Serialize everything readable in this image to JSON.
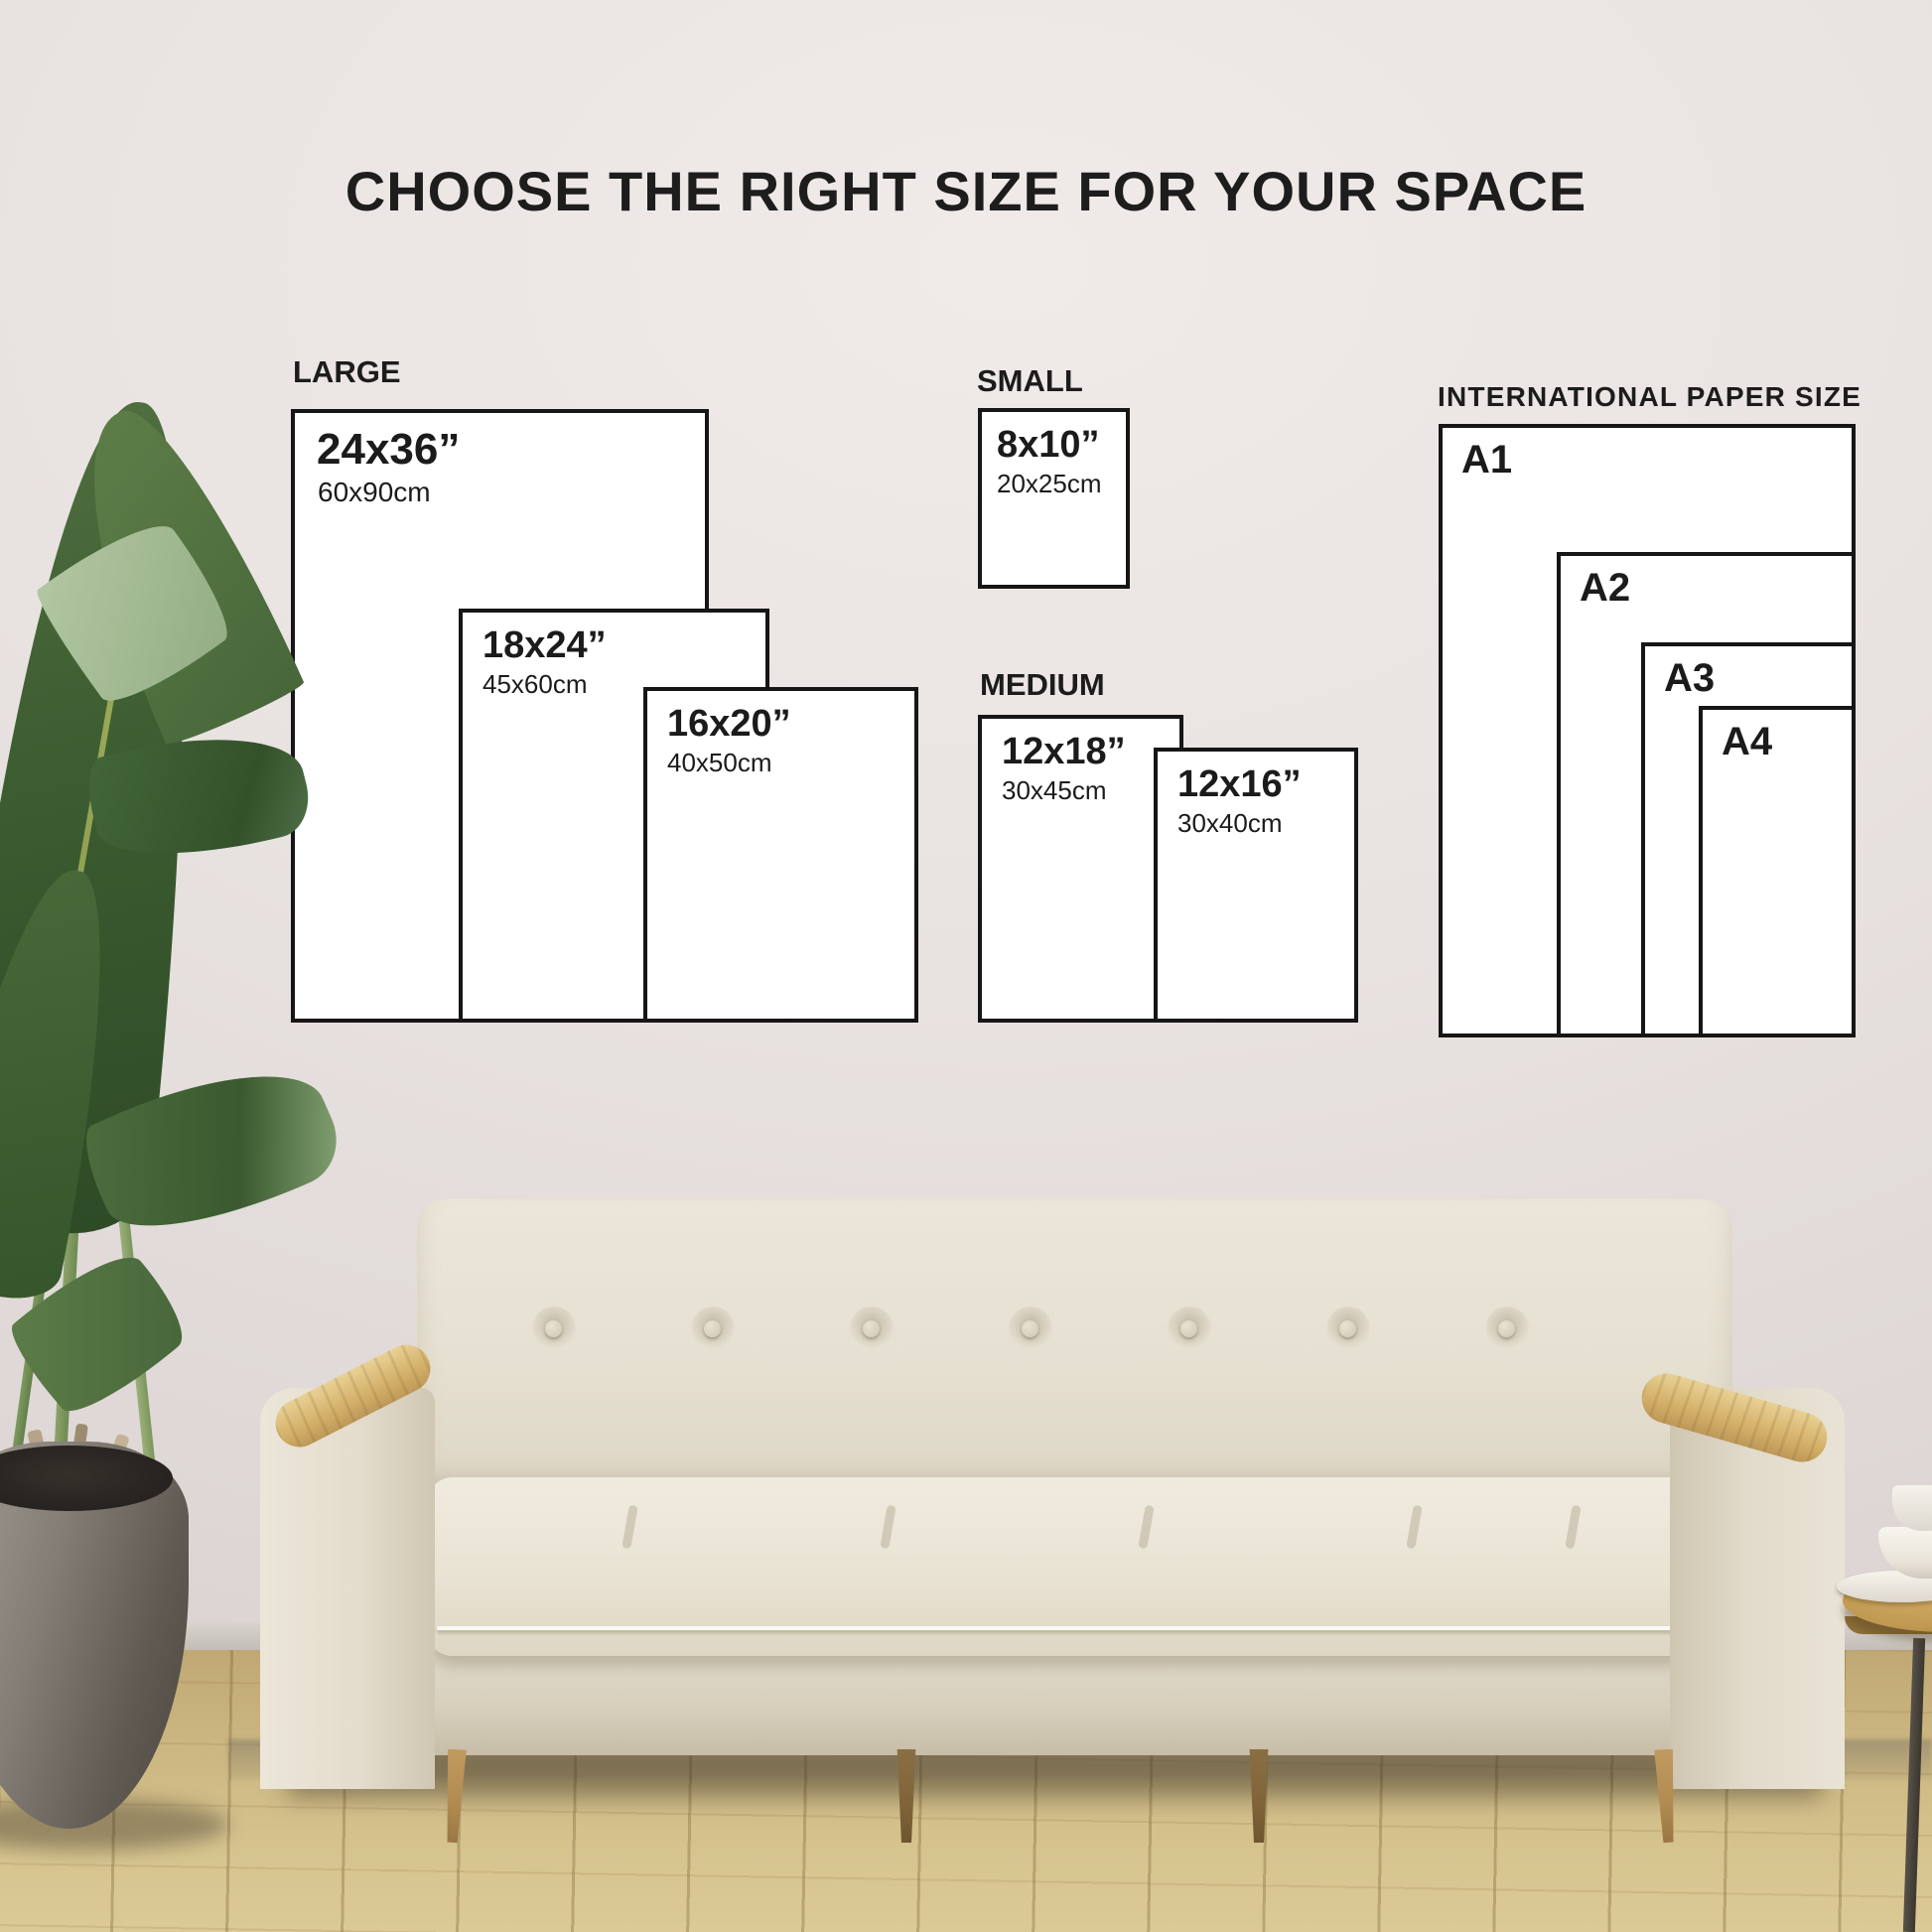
{
  "title": "CHOOSE THE RIGHT SIZE FOR YOUR SPACE",
  "groups": {
    "large": {
      "label": "LARGE",
      "sizes": [
        {
          "inches": "24x36”",
          "cm": "60x90cm"
        },
        {
          "inches": "18x24”",
          "cm": "45x60cm"
        },
        {
          "inches": "16x20”",
          "cm": "40x50cm"
        }
      ]
    },
    "small": {
      "label": "SMALL",
      "sizes": [
        {
          "inches": "8x10”",
          "cm": "20x25cm"
        }
      ]
    },
    "medium": {
      "label": "MEDIUM",
      "sizes": [
        {
          "inches": "12x18”",
          "cm": "30x45cm"
        },
        {
          "inches": "12x16”",
          "cm": "30x40cm"
        }
      ]
    },
    "international": {
      "label": "INTERNATIONAL PAPER SIZE",
      "sizes": [
        {
          "name": "A1"
        },
        {
          "name": "A2"
        },
        {
          "name": "A3"
        },
        {
          "name": "A4"
        }
      ]
    }
  },
  "colors": {
    "ink": "#1b1b1b",
    "box_fill": "#ffffff",
    "box_border": "#161616",
    "wall": "#e7e1df",
    "floor_wood": "#cdb884",
    "sofa_fabric": "#e6e0d3",
    "armrest_wood": "#d3ad67",
    "leaf_green": "#3c5c31",
    "pot_gray": "#7d7770",
    "table_wood": "#c09a52"
  }
}
